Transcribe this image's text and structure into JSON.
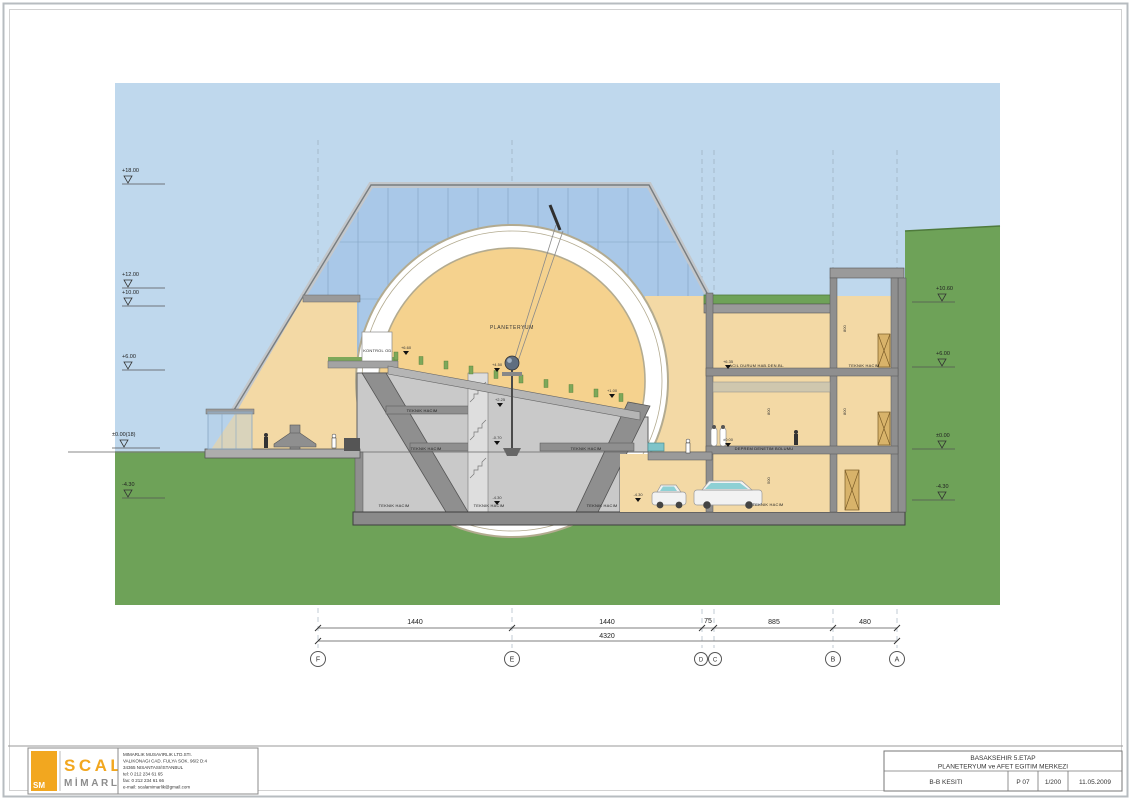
{
  "colors": {
    "sky": "#bfd8ed",
    "grass": "#6ea258",
    "grass_line": "#4f7a3c",
    "glass": "#a9c8e8",
    "mullion": "#7f9fc0",
    "tan": "#f3d9a5",
    "dome_inner": "#f5d28e",
    "ring_line": "#b3ab90",
    "concrete": "#8f8f8f",
    "room": "#c9c9c9",
    "accent_orange": "#f2a71f",
    "seat_green": "#7da85a",
    "skylight_teal": "#7fc4c9"
  },
  "labels": {
    "planetarium": "PLANETERYUM",
    "kontrol": "KONTROL OD.",
    "teknik": "TEKNIK HACIM",
    "acil": "ACIL DURUM HAB.DEN.BL.",
    "deprem": "DEPREM DENETIM BOLUMU"
  },
  "elevations": {
    "left": [
      "+18.00",
      "+12.00",
      "+10.00",
      "+6.00",
      "±0.00(18)",
      "-4.30"
    ],
    "right": [
      "+10.60",
      "+6.00",
      "±0.00",
      "-4.30"
    ]
  },
  "marks": {
    "seat_top": "+6.60",
    "seat_mid": "+4.50",
    "seat_low": "+1.00",
    "base_up": "+2.25",
    "base_mid": "-0.70",
    "base_low": "-4.30",
    "right_up": "+6.35",
    "right_zero": "±0.00",
    "park": "-4.30"
  },
  "dims": {
    "segments": [
      "1440",
      "1440",
      "75",
      "885",
      "480"
    ],
    "total": "4320",
    "grids": [
      "F",
      "E",
      "D",
      "C",
      "B",
      "A"
    ],
    "vertical": [
      "800",
      "800",
      "800",
      "500"
    ]
  },
  "titleblock": {
    "logo": {
      "monogram": "SM",
      "brand": "SCALA",
      "sub": "MİMARLIK"
    },
    "address": [
      "MIMARLIK MUSAVIRLIK LTD.STI.",
      "VALIKONAGI CAD. FULYA SOK. 96/2 D:4",
      "34365   NISANTASI/ISTANBUL",
      "tel: 0 212 234 61 65",
      "fax: 0 212 234 61 66",
      "e-mail: scalamimarlik@gmail.com"
    ],
    "project_line1": "BASAKSEHIR 5.ETAP",
    "project_line2": "PLANETERYUM ve AFET EGITIM MERKEZI",
    "drawing_name": "B-B KESITI",
    "sheet": "P 07",
    "scale": "1/200",
    "date": "11.05.2009"
  }
}
